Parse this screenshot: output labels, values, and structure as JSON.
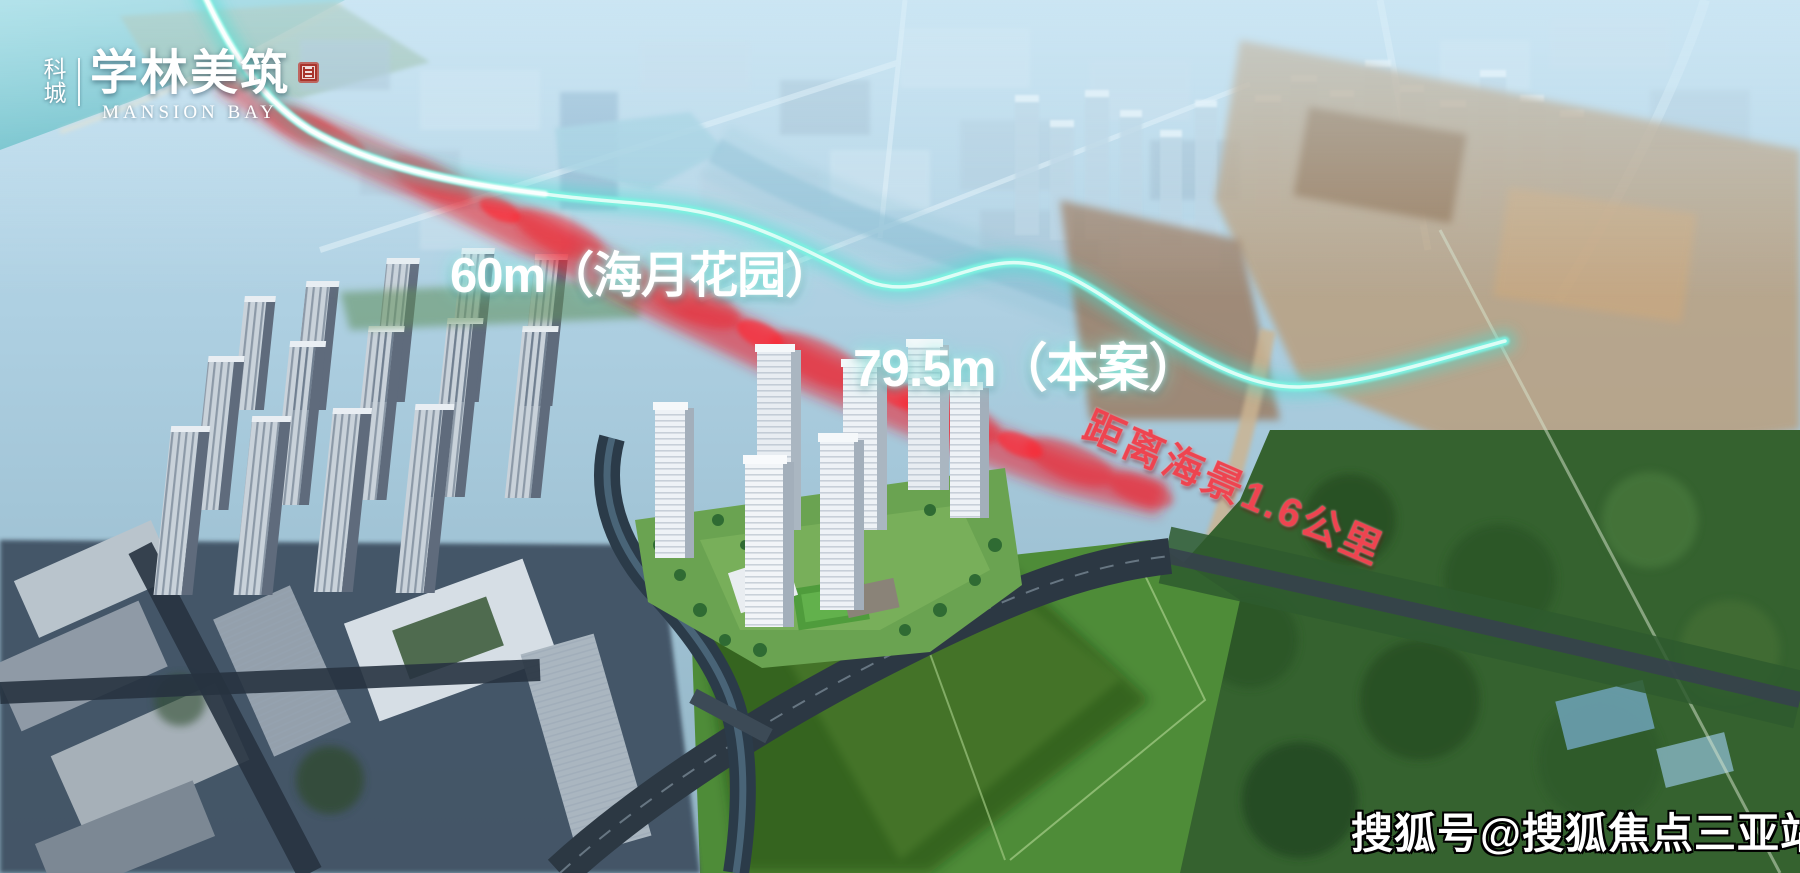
{
  "logo": {
    "prefix_vertical": "科城",
    "name": "学林美筑",
    "name_en": "MANSION BAY"
  },
  "labels": {
    "width_neighbor": "60m（海月花园）",
    "width_project": "79.5m（本案）",
    "sea_distance": "距离海景1.6公里"
  },
  "watermark": "搜狐号@搜狐焦点三亚站",
  "colors": {
    "route_line_cyan": "#6ff0de",
    "route_highlight_red": "#e8202f",
    "label_text": "#ffffff",
    "sea_distance_text": "#ee4450",
    "seal_red": "#a8332b",
    "ocean_teal": "#64c2c6",
    "haze_blue": "#aecfe1",
    "field_green": "#4e8c38",
    "dirt_tan": "#b99b78"
  }
}
